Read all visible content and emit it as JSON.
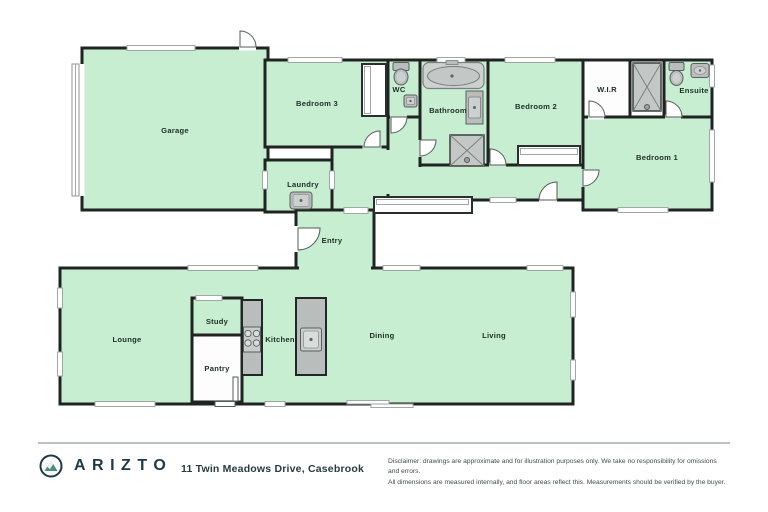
{
  "floorplan": {
    "rooms": {
      "garage": "Garage",
      "bedroom3": "Bedroom 3",
      "laundry": "Laundry",
      "wc": "WC",
      "bathroom": "Bathroom",
      "bedroom2": "Bedroom 2",
      "wir": "W.I.R",
      "ensuite": "Ensuite",
      "bedroom1": "Bedroom 1",
      "entry": "Entry",
      "lounge": "Lounge",
      "study": "Study",
      "pantry": "Pantry",
      "kitchen": "Kitchen",
      "dining": "Dining",
      "living": "Living"
    },
    "colors": {
      "room_fill": "#c8eed1",
      "wall": "#1f2422",
      "fixture": "#b9bdbc",
      "fixture_light": "#ccd0cf"
    }
  },
  "footer": {
    "brand": "ARIZTO",
    "address": "11 Twin Meadows Drive, Casebrook",
    "disclaimer_line1": "Disclaimer: drawings are approximate and for illustration purposes only. We take no responsibility for omissions and errors.",
    "disclaimer_line2": "All dimensions are measured internally, and floor areas reflect this. Measurements should be verified by the buyer."
  }
}
